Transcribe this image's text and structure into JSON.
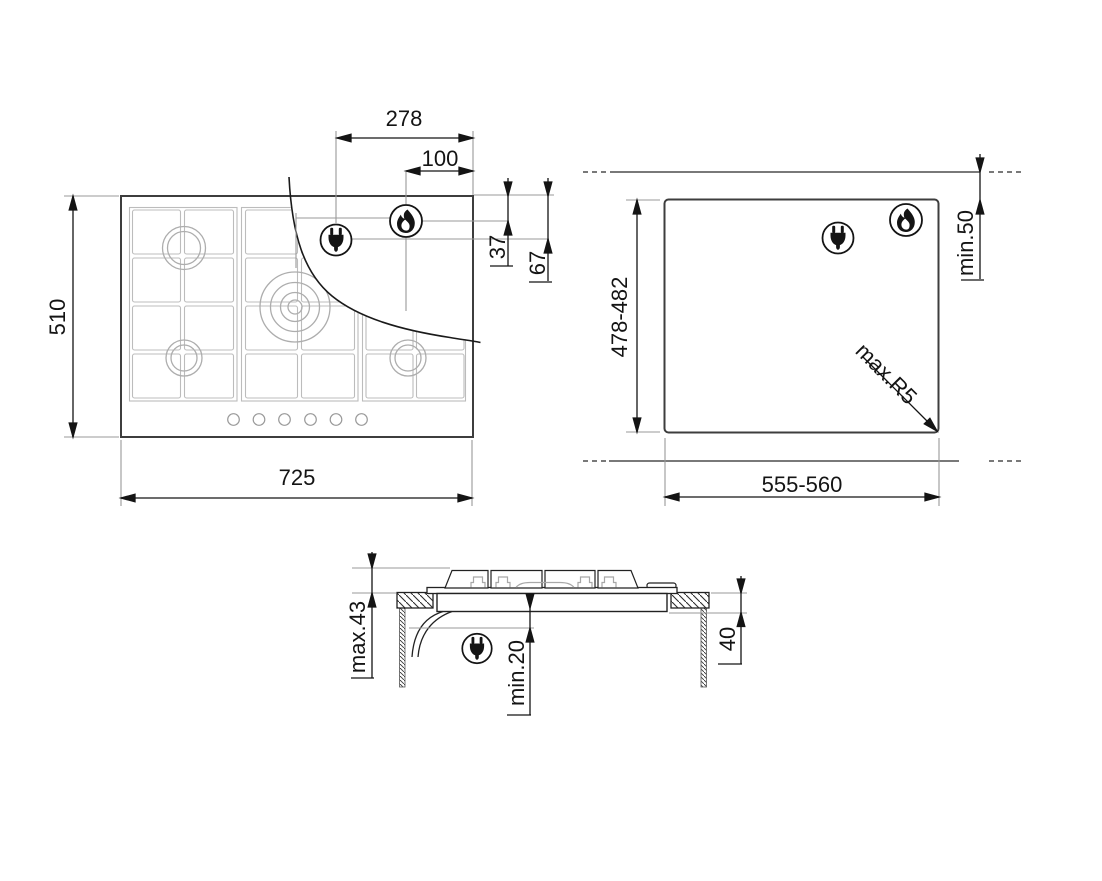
{
  "figure": {
    "type": "appliance-installation-drawing",
    "background": "#ffffff",
    "line_color": "#141414",
    "detail_line_color": "#b5b5b5",
    "views": {
      "top": {
        "labels": {
          "plug_offset_right": "278",
          "burner_offset_right": "100",
          "burner_offset_top": "37",
          "plug_offset_top": "67",
          "overall_depth": "510",
          "overall_width": "725"
        }
      },
      "cutout": {
        "labels": {
          "cutout_depth": "478-482",
          "cutout_width": "555-560",
          "rear_clearance": "min.50",
          "corner_radius": "max.R5"
        }
      },
      "side": {
        "labels": {
          "height_above_worktop": "max.43",
          "clearance_below": "min.20",
          "recess_depth": "40"
        }
      }
    },
    "icons": {
      "plug": "power-plug-icon",
      "flame": "gas-flame-icon"
    }
  }
}
